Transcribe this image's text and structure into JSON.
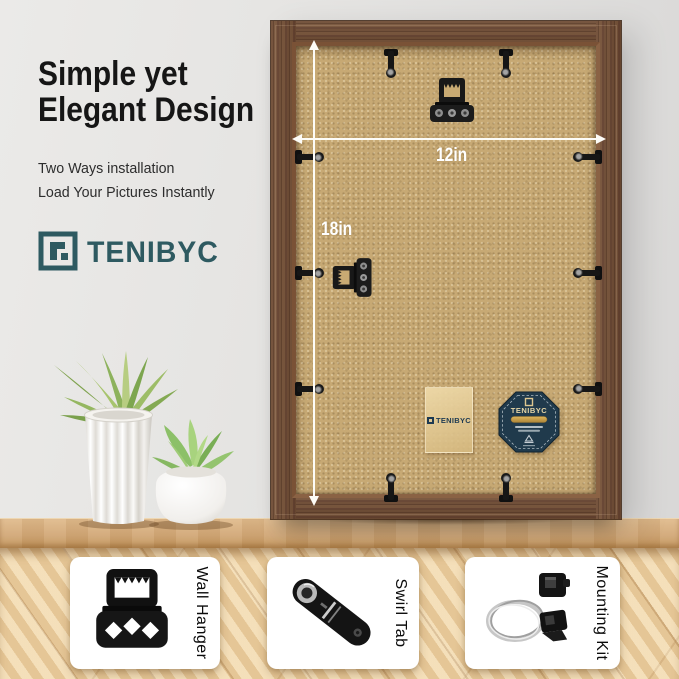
{
  "headline": {
    "line1": "Simple yet",
    "line2": "Elegant Design"
  },
  "subheadline": {
    "line1": "Two Ways installation",
    "line2": "Load Your Pictures Instantly"
  },
  "brand": {
    "wordmark": "TENIBYC"
  },
  "frame": {
    "width_label": "12in",
    "height_label": "18in",
    "sticker_wordmark": "TENIBYC",
    "badge_wordmark": "TENIBYC",
    "hardware_icons": [
      "sawtooth-hanger-icon",
      "swirl-tab-icon"
    ]
  },
  "features": [
    {
      "label": "Wall Hanger",
      "icon": "sawtooth-hanger-icon"
    },
    {
      "label": "Swirl Tab",
      "icon": "swirl-tab-icon"
    },
    {
      "label": "Mounting Kit",
      "icon": "mounting-kit-icon"
    }
  ],
  "colors": {
    "brand_teal": "#2e5a61",
    "wall_gray": "#e4e3e1",
    "frame_wood_brown": "#6d4a33",
    "backing_tan": "#c7a974",
    "dimension_white": "#fdfcf7",
    "badge_navy": "#203a4c",
    "badge_gold": "#c9a04e",
    "table_oak": "#e3c496"
  }
}
